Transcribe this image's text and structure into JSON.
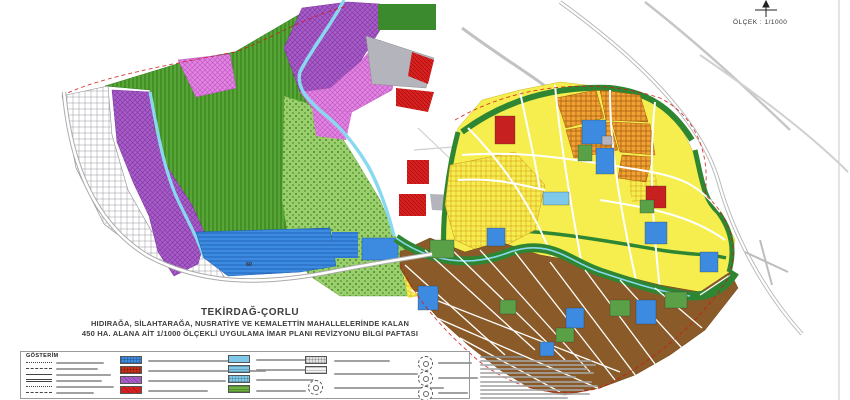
{
  "header": {
    "north_arrow_icon": "north-arrow-icon",
    "scale_label": "ÖLÇEK : 1/1000"
  },
  "title": {
    "line1": "TEKİRDAĞ-ÇORLU",
    "line2": "HIDIRAĞA, SİLAHTARAĞA, NUSRATİYE VE KEMALETTİN MAHALLELERİNDE KALAN",
    "line3": "450 HA. ALANA AİT 1/1000 ÖLÇEKLİ UYGULAMA İMAR PLANI REVİZYONU BİLGİ PAFTASI"
  },
  "map": {
    "road_marker_label": "60",
    "palette": {
      "agriculture_green_striped": "#58a736",
      "park_light_green_dotted": "#9ad06b",
      "corridor_dark_green": "#2f8632",
      "zone_purple_crosshatch": "#a85cc8",
      "zone_pink_crosshatch": "#e383e3",
      "residential_yellow": "#f6ee4e",
      "residential_orange_hatch": "#f0a232",
      "existing_urban_brown": "#8a5a28",
      "facility_blue": "#3d8be0",
      "commercial_red": "#d92121",
      "technical_gray": "#b4b4bc",
      "water_light_blue": "#88d8f0",
      "military_hatched_white": "#ffffff",
      "road_white": "#ffffff",
      "plan_boundary_red_dash": "#d01818"
    }
  },
  "legend": {
    "header": "GÖSTERİM",
    "line_symbols": [
      {
        "name": "legend-line-boundary-circles"
      },
      {
        "name": "legend-line-dashed"
      },
      {
        "name": "legend-line-dashdot"
      },
      {
        "name": "legend-line-double"
      },
      {
        "name": "legend-line-dotted"
      },
      {
        "name": "legend-line-solid"
      }
    ],
    "column2_swatches": [
      {
        "name": "swatch-blue-hatched",
        "color": "#3d8be0",
        "pattern": "grid"
      },
      {
        "name": "swatch-darkred-hatched",
        "color": "#c23018",
        "pattern": "grid"
      },
      {
        "name": "swatch-purple",
        "color": "#a85cc8",
        "pattern": "diag"
      },
      {
        "name": "swatch-red",
        "color": "#d92121",
        "pattern": "diag"
      }
    ],
    "column3_swatches": [
      {
        "name": "swatch-lightblue-1",
        "color": "#7ec8ea",
        "pattern": ""
      },
      {
        "name": "swatch-lightblue-2",
        "color": "#7ec8ea",
        "pattern": "hlines"
      },
      {
        "name": "swatch-lightblue-3",
        "color": "#7ec8ea",
        "pattern": "grid"
      },
      {
        "name": "swatch-green",
        "color": "#6cb13d",
        "pattern": "hlines"
      }
    ],
    "column4_swatches": [
      {
        "name": "swatch-gray-crosshatch",
        "color": "#e2e2e2",
        "pattern": "grid"
      },
      {
        "name": "swatch-gray-lines",
        "color": "#f4f4f4",
        "pattern": "hlines"
      }
    ],
    "circle_symbols": [
      {
        "name": "legend-symbol-circle-1"
      },
      {
        "name": "legend-symbol-circle-2"
      },
      {
        "name": "legend-symbol-circle-3"
      }
    ]
  }
}
